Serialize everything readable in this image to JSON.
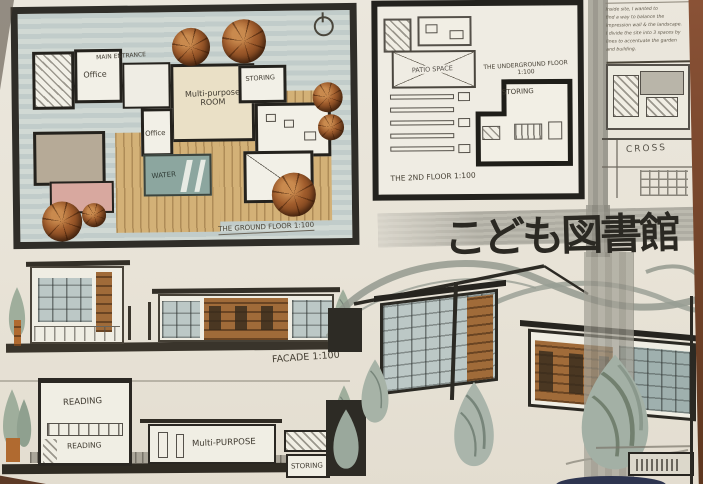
{
  "board_title": {
    "japanese": "こども図書館"
  },
  "plans": {
    "ground_floor": {
      "caption": "THE GROUND FLOOR 1:100",
      "rooms": {
        "office_upper": "Office",
        "main_entrance": "MAIN ENTRANCE",
        "multi_purpose": "Multi-purpose ROOM",
        "storing": "STORING",
        "office_lower": "Office",
        "water": "WATER"
      }
    },
    "second_floor": {
      "caption": "THE 2ND FLOOR 1:100",
      "rooms": {
        "patio": "PATIO SPACE"
      }
    },
    "underground": {
      "caption": "THE UNDERGROUND FLOOR 1:100",
      "rooms": {
        "storing": "STORING"
      }
    }
  },
  "sections": {
    "cross_label": "CROSS",
    "facade_caption": "FACADE 1:100",
    "long_section": {
      "reading_upper": "READING",
      "reading_lower": "READING",
      "multi_purpose": "Multi-PURPOSE",
      "storing": "STORING"
    }
  },
  "notes": {
    "text": "Inside site, I wanted to\nfind a way to balance the\nimpression wall & the landscape.\nI divide the site into 3 spaces by\nlines to accentuate the garden\nand building."
  },
  "colors": {
    "paper": "#e9e5da",
    "ink": "#2c2a24",
    "marker_blue_gray": "#bcc8c6",
    "marker_wood": "#d3b177",
    "marker_copper": "#8e4f26",
    "marker_gray": "#9a988e",
    "water": "#8ca69f",
    "table_brown": "#6d422c"
  }
}
